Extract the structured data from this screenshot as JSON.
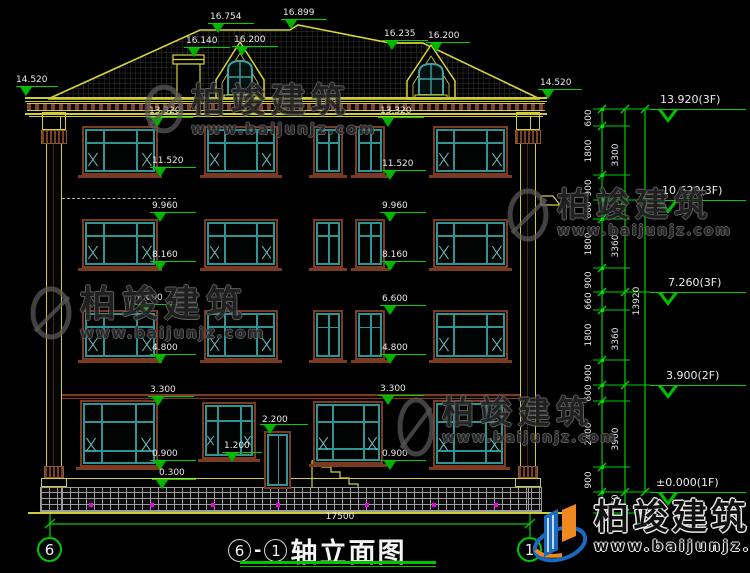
{
  "drawing_title": {
    "axis_from": "6",
    "sep": "-",
    "axis_to": "1",
    "text": "轴立面图"
  },
  "axis_bubbles": {
    "left": "6",
    "right": "1"
  },
  "watermark": {
    "brand": "柏竣建筑",
    "url": "www.baijunjz.com"
  },
  "colors": {
    "background": "#000000",
    "dim_green": "#00cf00",
    "cad_yellow": "#cfcc38",
    "window_teal": "#2f9494",
    "surround_brown": "#7a3a24",
    "dot_magenta": "#ee00ee",
    "logo_blue": "#1a6ac0",
    "logo_orange": "#f08820"
  },
  "annotations": {
    "roof_14520_left": "14.520",
    "ridge_16754": "16.754",
    "ridge_16899": "16.899",
    "chimney_16140": "16.140",
    "dormer1_16200": "16.200",
    "ridge_16235": "16.235",
    "dormer2_16200": "16.200",
    "roof_14520_right": "14.520",
    "L_13320": "13.320",
    "L_11520": "11.520",
    "L_9960": "9.960",
    "L_8160": "8.160",
    "L_6600": "6.600",
    "L_4800": "4.800",
    "L_3300": "3.300",
    "L_0900": "0.900",
    "L_0300": "0.300",
    "R_13320": "13.320",
    "R_11520": "11.520",
    "R_9960": "9.960",
    "R_8160": "8.160",
    "R_6600": "6.600",
    "R_4800": "4.800",
    "R_3300": "3.300",
    "R_0900": "0.900",
    "door_2200": "2.200",
    "door_1200": "1.200",
    "total_width": "17500"
  },
  "dim_chain": {
    "inner_segments": [
      "600",
      "1800",
      "900",
      "660",
      "1800",
      "900",
      "660",
      "1800",
      "900",
      "600",
      "2400",
      "900"
    ],
    "mid_segments": [
      "3300",
      "3360",
      "3360",
      "3900",
      "750"
    ],
    "total": "13920"
  },
  "levels": [
    "13.920(3F)",
    "10.620(3F)",
    "7.260(3F)",
    "3.900(2F)",
    "±0.000(1F)"
  ]
}
